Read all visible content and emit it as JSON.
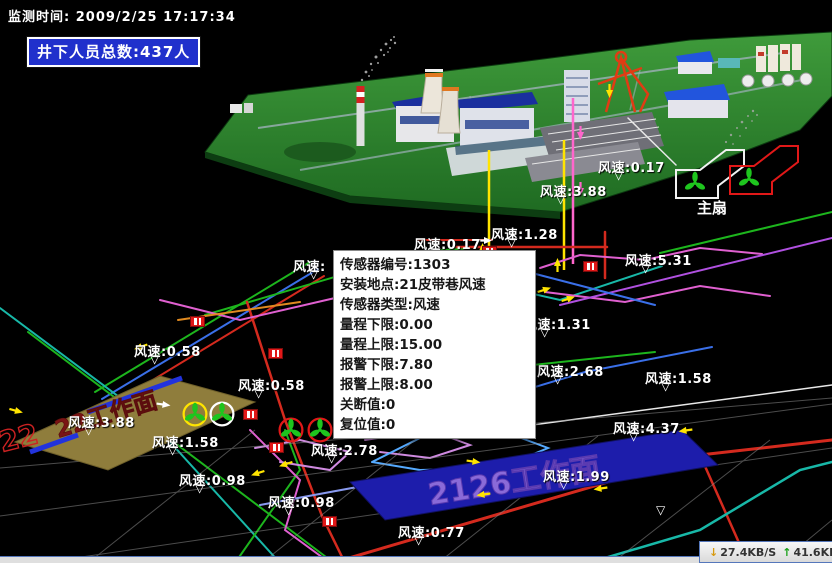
{
  "header": {
    "monitor_time": "监测时间: 2009/2/25 17:17:34",
    "personnel_total": "井下人员总数:437人"
  },
  "sensor_popup": {
    "lines": [
      "传感器编号:1303",
      "安装地点:21皮带巷风速",
      "传感器类型:风速",
      "量程下限:0.00",
      "量程上限:15.00",
      "报警下限:7.80",
      "报警上限:8.00",
      "关断值:0",
      "复位值:0"
    ]
  },
  "main_fan": {
    "label": "主扇"
  },
  "banners": {
    "left_face": "22工作面",
    "right_face": "2126工作面"
  },
  "status_bar": {
    "down_arrow": "↓",
    "download_speed": "27.4KB/S",
    "up_arrow": "↑",
    "upload_speed": "41.6KB/"
  },
  "colors": {
    "badge_blue": "#2030cc",
    "alarm_red": "#e11818",
    "fan_green": "#1ec51e",
    "label_white": "#ffffff"
  },
  "wind_labels": [
    {
      "text": "风速:0.17",
      "x": 598,
      "y": 157
    },
    {
      "text": "风速:3.88",
      "x": 540,
      "y": 181
    },
    {
      "text": "风速:1.28",
      "x": 491,
      "y": 224
    },
    {
      "text": "风速:0.17",
      "x": 414,
      "y": 234
    },
    {
      "text": "风速:5.31",
      "x": 625,
      "y": 250
    },
    {
      "text": "风速:",
      "x": 293,
      "y": 256
    },
    {
      "text": "风速:1.31",
      "x": 524,
      "y": 314
    },
    {
      "text": "风速:0.58",
      "x": 134,
      "y": 341
    },
    {
      "text": "风速:2.68",
      "x": 537,
      "y": 361
    },
    {
      "text": "风速:0.58",
      "x": 238,
      "y": 375
    },
    {
      "text": "风速:1.58",
      "x": 645,
      "y": 368
    },
    {
      "text": "风速:3.88",
      "x": 68,
      "y": 412
    },
    {
      "text": "风速:4.37",
      "x": 613,
      "y": 418
    },
    {
      "text": "风速:1.58",
      "x": 152,
      "y": 432
    },
    {
      "text": "风速:2.78",
      "x": 311,
      "y": 440
    },
    {
      "text": "风速:0.98",
      "x": 179,
      "y": 470
    },
    {
      "text": "风速:1.99",
      "x": 543,
      "y": 466
    },
    {
      "text": "风速:0.98",
      "x": 268,
      "y": 492
    },
    {
      "text": "风速:0.77",
      "x": 398,
      "y": 522
    }
  ],
  "extra_pointers": [
    {
      "x": 656,
      "y": 504
    }
  ],
  "sensor_markers": [
    {
      "x": 190,
      "y": 316
    },
    {
      "x": 268,
      "y": 348
    },
    {
      "x": 482,
      "y": 246
    },
    {
      "x": 583,
      "y": 261
    },
    {
      "x": 243,
      "y": 409
    },
    {
      "x": 269,
      "y": 442
    },
    {
      "x": 322,
      "y": 516
    }
  ],
  "fans": [
    {
      "x": 195,
      "y": 414,
      "r": 13,
      "ring": "yellow"
    },
    {
      "x": 222,
      "y": 414,
      "r": 13,
      "ring": "white"
    },
    {
      "x": 291,
      "y": 430,
      "r": 13,
      "ring": "red"
    },
    {
      "x": 320,
      "y": 430,
      "r": 13,
      "ring": "red"
    },
    {
      "x": 695,
      "y": 183,
      "r": 13,
      "ring": "none"
    },
    {
      "x": 749,
      "y": 179,
      "r": 13,
      "ring": "none"
    }
  ]
}
